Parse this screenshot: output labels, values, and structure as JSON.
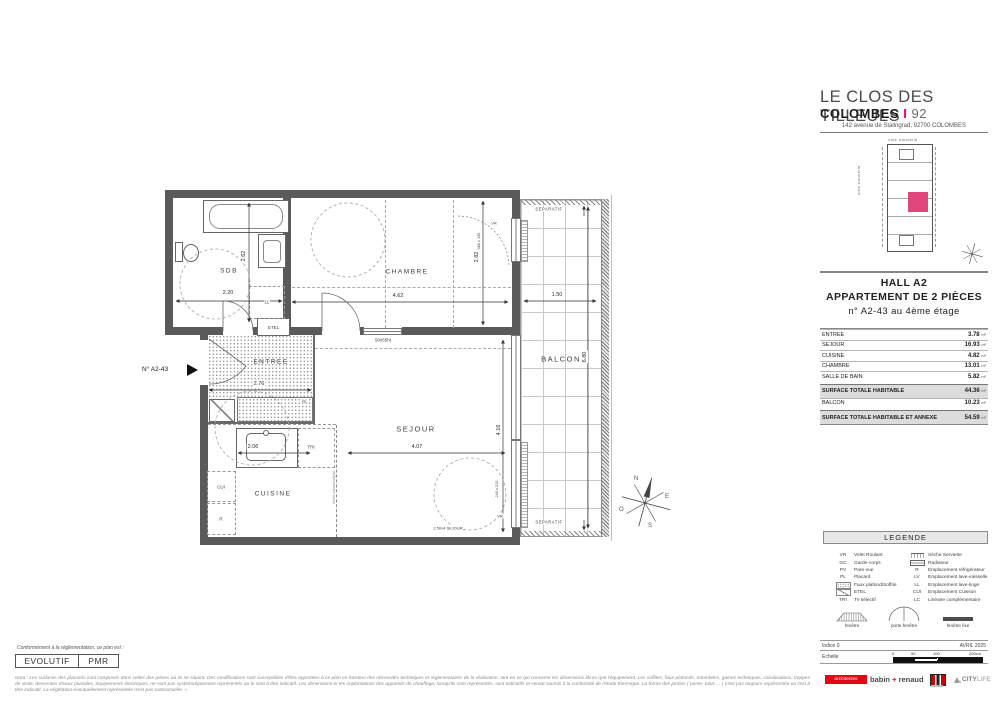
{
  "header": {
    "title": "LE CLOS DES TILLEULS",
    "city": "COLOMBES",
    "sep": "I",
    "dept": "92",
    "address": "142 avenue de Stalingrad, 92700 COLOMBES"
  },
  "siteplan": {
    "road_top": "voie nouvelle",
    "road_left": "voie nouvelle",
    "highlight_color": "#e0457b"
  },
  "unit": {
    "hall": "HALL A2",
    "type": "APPARTEMENT DE 2 PIÈCES",
    "number": "n° A2-43 au 4ème étage"
  },
  "areas": {
    "unit": "m²",
    "rows": [
      {
        "label": "ENTREE",
        "value": "3.78"
      },
      {
        "label": "SEJOUR",
        "value": "16.93"
      },
      {
        "label": "CUISINE",
        "value": "4.82"
      },
      {
        "label": "CHAMBRE",
        "value": "13.01"
      },
      {
        "label": "SALLE DE BAIN",
        "value": "5.82"
      },
      {
        "label": "SURFACE TOTALE HABITABLE",
        "value": "44.36"
      },
      {
        "label": "BALCON",
        "value": "10.23"
      },
      {
        "label": "SURFACE TOTALE HABITABLE ET ANNEXE",
        "value": "54.59"
      }
    ]
  },
  "legend": {
    "title": "LEGENDE",
    "left": [
      {
        "code": "VR",
        "label": "Volet Roulant"
      },
      {
        "code": "GC",
        "label": "Garde-corps"
      },
      {
        "code": "PV",
        "label": "Pare-vue"
      },
      {
        "code": "PL",
        "label": "Placard"
      },
      {
        "code": "",
        "label": "Faux plafond/Soffite"
      },
      {
        "code": "",
        "label": "ETEL"
      },
      {
        "code": "TRI",
        "label": "Tri sélectif"
      }
    ],
    "right": [
      {
        "code": "",
        "label": "Sèche Serviette"
      },
      {
        "code": "",
        "label": "Radiateur"
      },
      {
        "code": "R",
        "label": "Emplacement réfrigérateur"
      },
      {
        "code": "LV",
        "label": "Emplacement lave-vaisselle"
      },
      {
        "code": "LL",
        "label": "Emplacement lave-linge"
      },
      {
        "code": "CUI",
        "label": "Emplacement Cuisson"
      },
      {
        "code": "LC",
        "label": "Linéaire complémentaire"
      }
    ],
    "windows": [
      "fenêtre",
      "porte fenêtre",
      "fenêtre fixe"
    ]
  },
  "titleblock": {
    "indice": "Indice 0",
    "date": "AVRIL 2025",
    "echelle": "Echelle",
    "ticks": [
      "0",
      "50",
      "100",
      "200cm"
    ]
  },
  "logos": {
    "architectes": "architectes",
    "babin": "babin",
    "plus": "+",
    "renaud": "renaud",
    "citylife_city": "CITY",
    "citylife_life": "LIFE"
  },
  "compliance": {
    "intro": "Conformément à la réglementation, ce plan est :",
    "evolutif": "EVOLUTIF",
    "pmr": "PMR"
  },
  "nota": "Nota : Les surfaces des placards sont comprises dans celles des pièces où ils se situent. Des modifications sont susceptibles d'être apportées à ce plan en fonction des nécessités techniques et réglementaires de la réalisation, tant en ce qui concerne les dimensions libres que l'équipement. Les soffites, faux-plafonds, retombées, gaines techniques, canalisations, trappes de visite, descentes d'eaux pluviales, équipements électriques, ne sont pas systématiquement représentés ou le sont à titre indicatif. Les dimensions et les implantations des appareils de chauffage, lorsqu'ils sont représentés, sont indicatifs et seront soumis à la conformité de l'étude thermique. La forme des jardins ( pente, talus ... ) n'est pas toujours représentée ou l'est à titre indicatif. La végétation éventuellement représentée n'est pas contractuelle. »",
  "plan": {
    "marker": "N° A2-43",
    "rooms": {
      "sdb": "SDB",
      "chambre": "CHAMBRE",
      "entree": "ENTREE",
      "sejour": "SEJOUR",
      "cuisine": "CUISINE",
      "balcon": "BALCON"
    },
    "dims": {
      "sdb_w": "2.20",
      "sdb_h": "2.62",
      "chambre_w": "4.62",
      "chambre_h": "2.82",
      "entree_w": "2.76",
      "cuisine_w": "2.06",
      "sejour_w": "4.07",
      "sejour_h": "4.16",
      "balcon_w": "1.50",
      "balcon_h": "6.80"
    },
    "tags": {
      "ll": "LL",
      "etel": "ETEL",
      "pl": "PL",
      "tri": "TRI",
      "cui": "CUI",
      "r": "R",
      "vr1": "VR",
      "vr2": "VR",
      "win_int": "50x55ht",
      "win_sejour": "2.50x4 SEJOUR",
      "win_chambre_dim": "060 x 195",
      "win_sejour_dim": "240 x 215",
      "limite": "limite cuisine/séjour",
      "separatif_top": "SEPARATIF",
      "separatif_bottom": "SEPARATIF"
    },
    "compass": {
      "n": "N",
      "e": "E",
      "s": "S",
      "o": "O"
    }
  }
}
